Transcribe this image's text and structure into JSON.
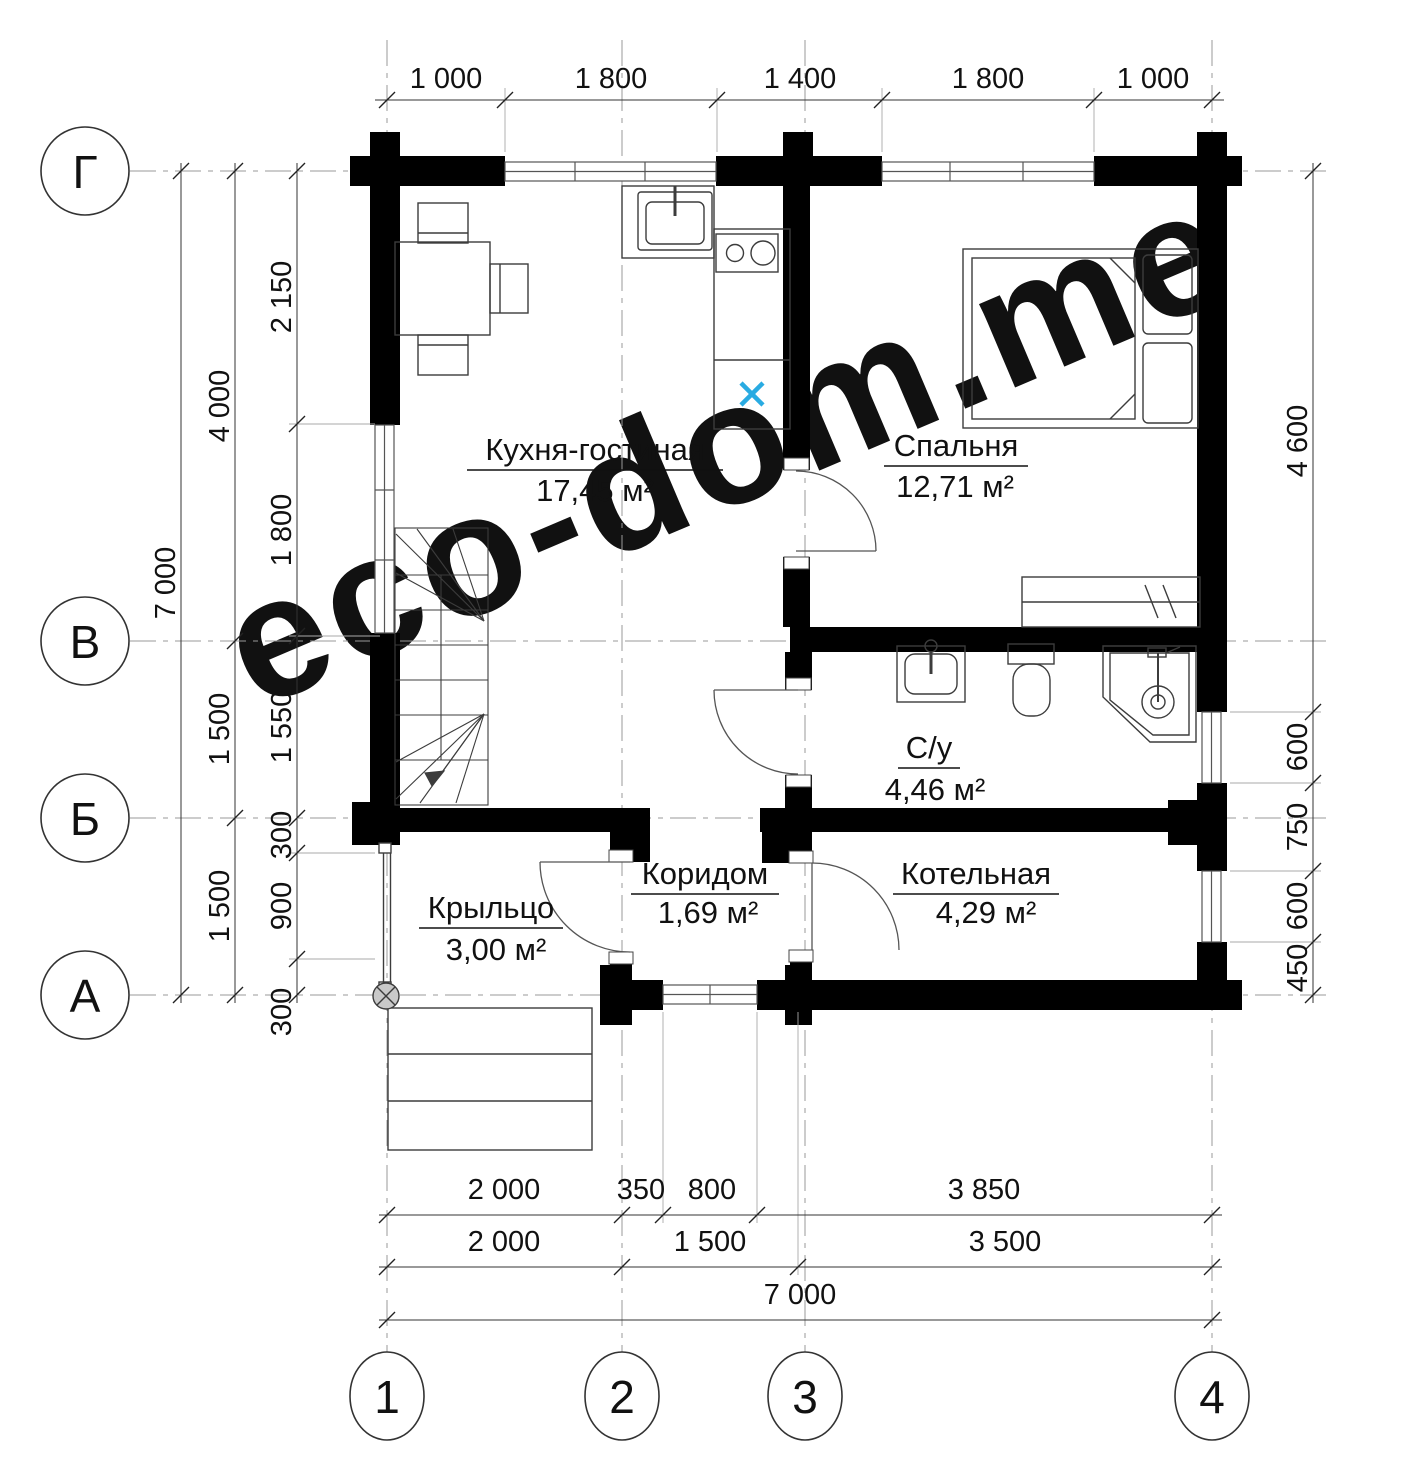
{
  "watermark": {
    "text": "eco-dom.me"
  },
  "axes": {
    "horizontal": [
      "Г",
      "В",
      "Б",
      "А"
    ],
    "vertical": [
      "1",
      "2",
      "3",
      "4"
    ]
  },
  "rooms": [
    {
      "name": "Кухня-гостиная",
      "area": "17,45 м²"
    },
    {
      "name": "Спальня",
      "area": "12,71 м²"
    },
    {
      "name": "С/у",
      "area": "4,46 м²"
    },
    {
      "name": "Коридом",
      "area": "1,69 м²"
    },
    {
      "name": "Котельная",
      "area": "4,29 м²"
    },
    {
      "name": "Крыльцо",
      "area": "3,00 м²"
    }
  ],
  "dimensions": {
    "top": [
      "1 000",
      "1 800",
      "1 400",
      "1 800",
      "1 000"
    ],
    "left_inner": [
      "2 150",
      "1 800",
      "1 550",
      "300",
      "900",
      "300"
    ],
    "left_middle": [
      "4 000",
      "1 500",
      "1 500"
    ],
    "left_outer": [
      "7 000"
    ],
    "right": [
      "4 600",
      "600",
      "750",
      "600",
      "450"
    ],
    "bottom_row1": [
      "2 000",
      "350",
      "800",
      "3 850"
    ],
    "bottom_row2": [
      "2 000",
      "1 500",
      "3 500"
    ],
    "bottom_row3": [
      "7 000"
    ]
  },
  "colors": {
    "wall": "#000000",
    "line": "#3c3c3c",
    "axis_line": "#999999",
    "dimension": "#111111",
    "watermark": "#f1eecf",
    "marker_blue": "#29abe2",
    "background": "#ffffff"
  }
}
